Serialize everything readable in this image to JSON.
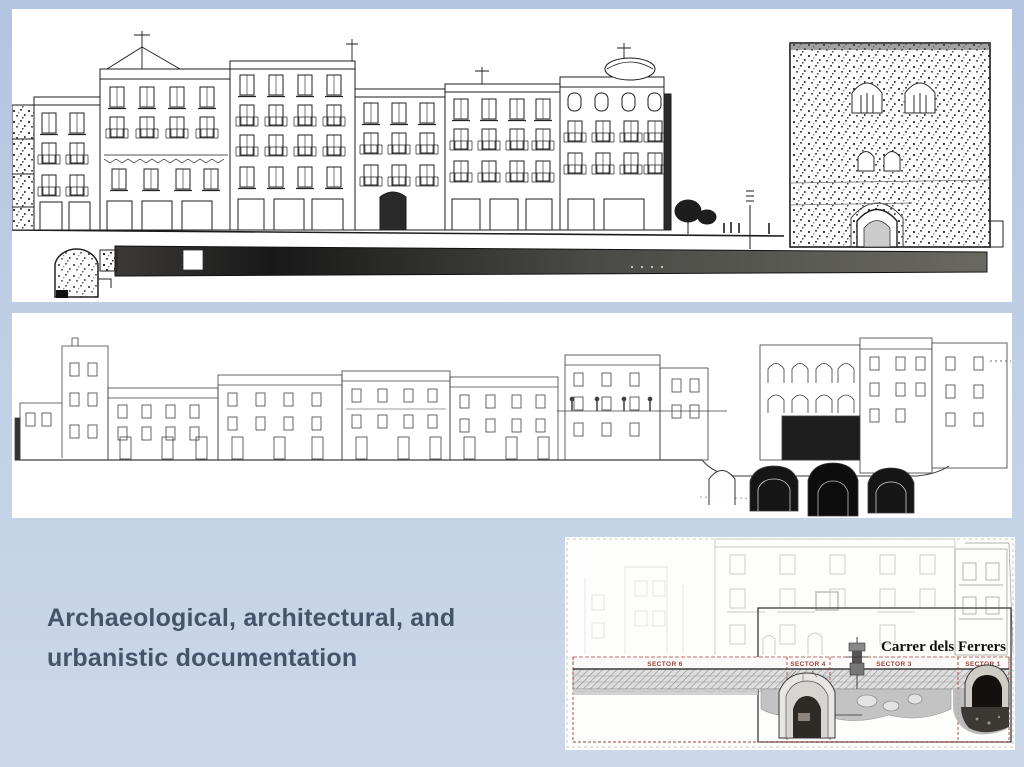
{
  "slide": {
    "title": {
      "line1": "Archaeological, architectural, and",
      "line2": "urbanistic documentation"
    },
    "colors": {
      "background_top": "#b2c4e0",
      "background_bottom": "#ccd8ea",
      "panel": "#ffffff",
      "title_text": "#44546a",
      "sector_label_red": "#9e3c33",
      "street_label_black": "#111111",
      "drawing_ink": "#1c1c1c"
    }
  },
  "excavation_plan": {
    "street_label": "Carrer dels Ferrers",
    "sectors": [
      "SECTOR 6",
      "SECTOR 4",
      "SECTOR 3",
      "SECTOR 1"
    ]
  }
}
